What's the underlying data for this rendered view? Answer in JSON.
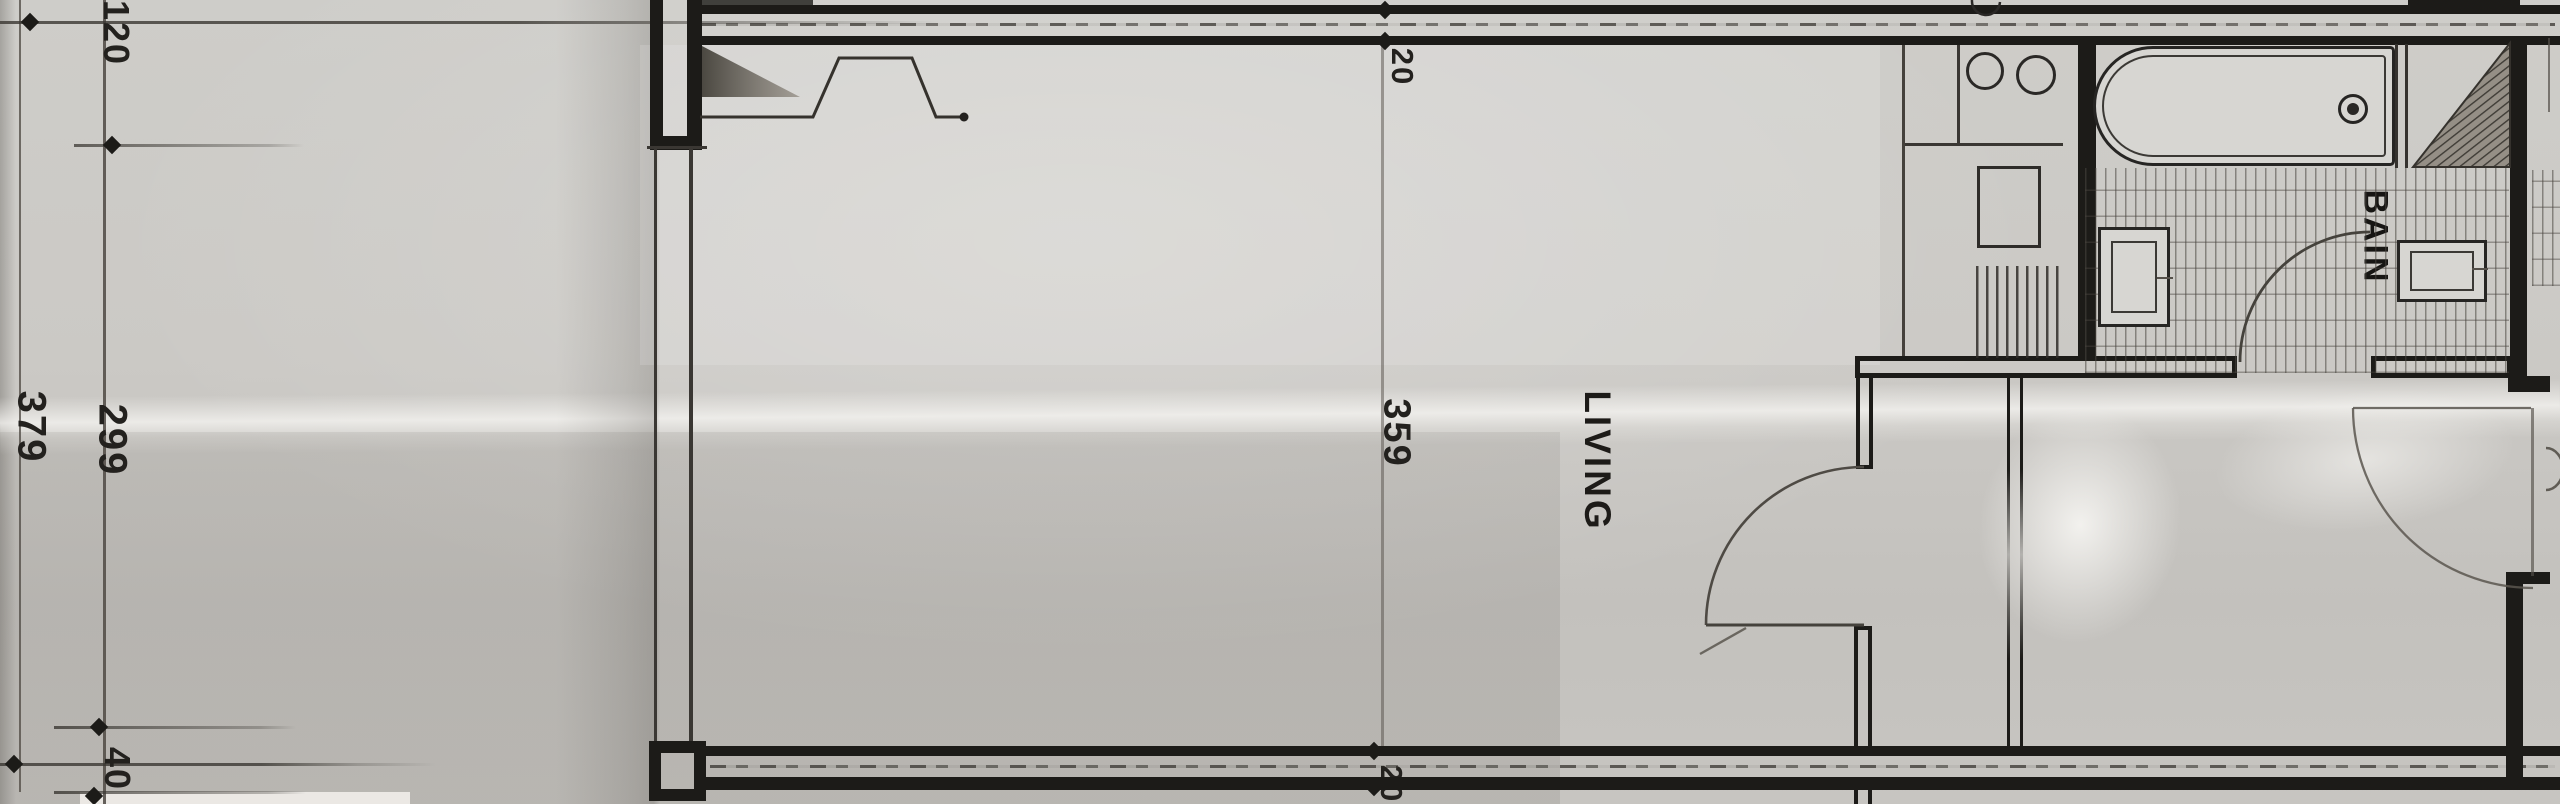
{
  "title": "Scanned hand-drawn apartment floor plan",
  "rooms": {
    "living": "LIVING",
    "bath": "BAIN"
  },
  "dimensions": {
    "chain_outer": "379",
    "chain_inner_top": "120",
    "chain_inner_middle": "299",
    "chain_inner_bottom": "40",
    "top_wall_thickness": "20",
    "living_depth": "359",
    "bottom_wall_thickness": "20"
  },
  "colors": {
    "ink": "#1c1b18",
    "pencil": "#55504a",
    "paper": "#cbc9c5",
    "tile-line": "#4a463f"
  }
}
